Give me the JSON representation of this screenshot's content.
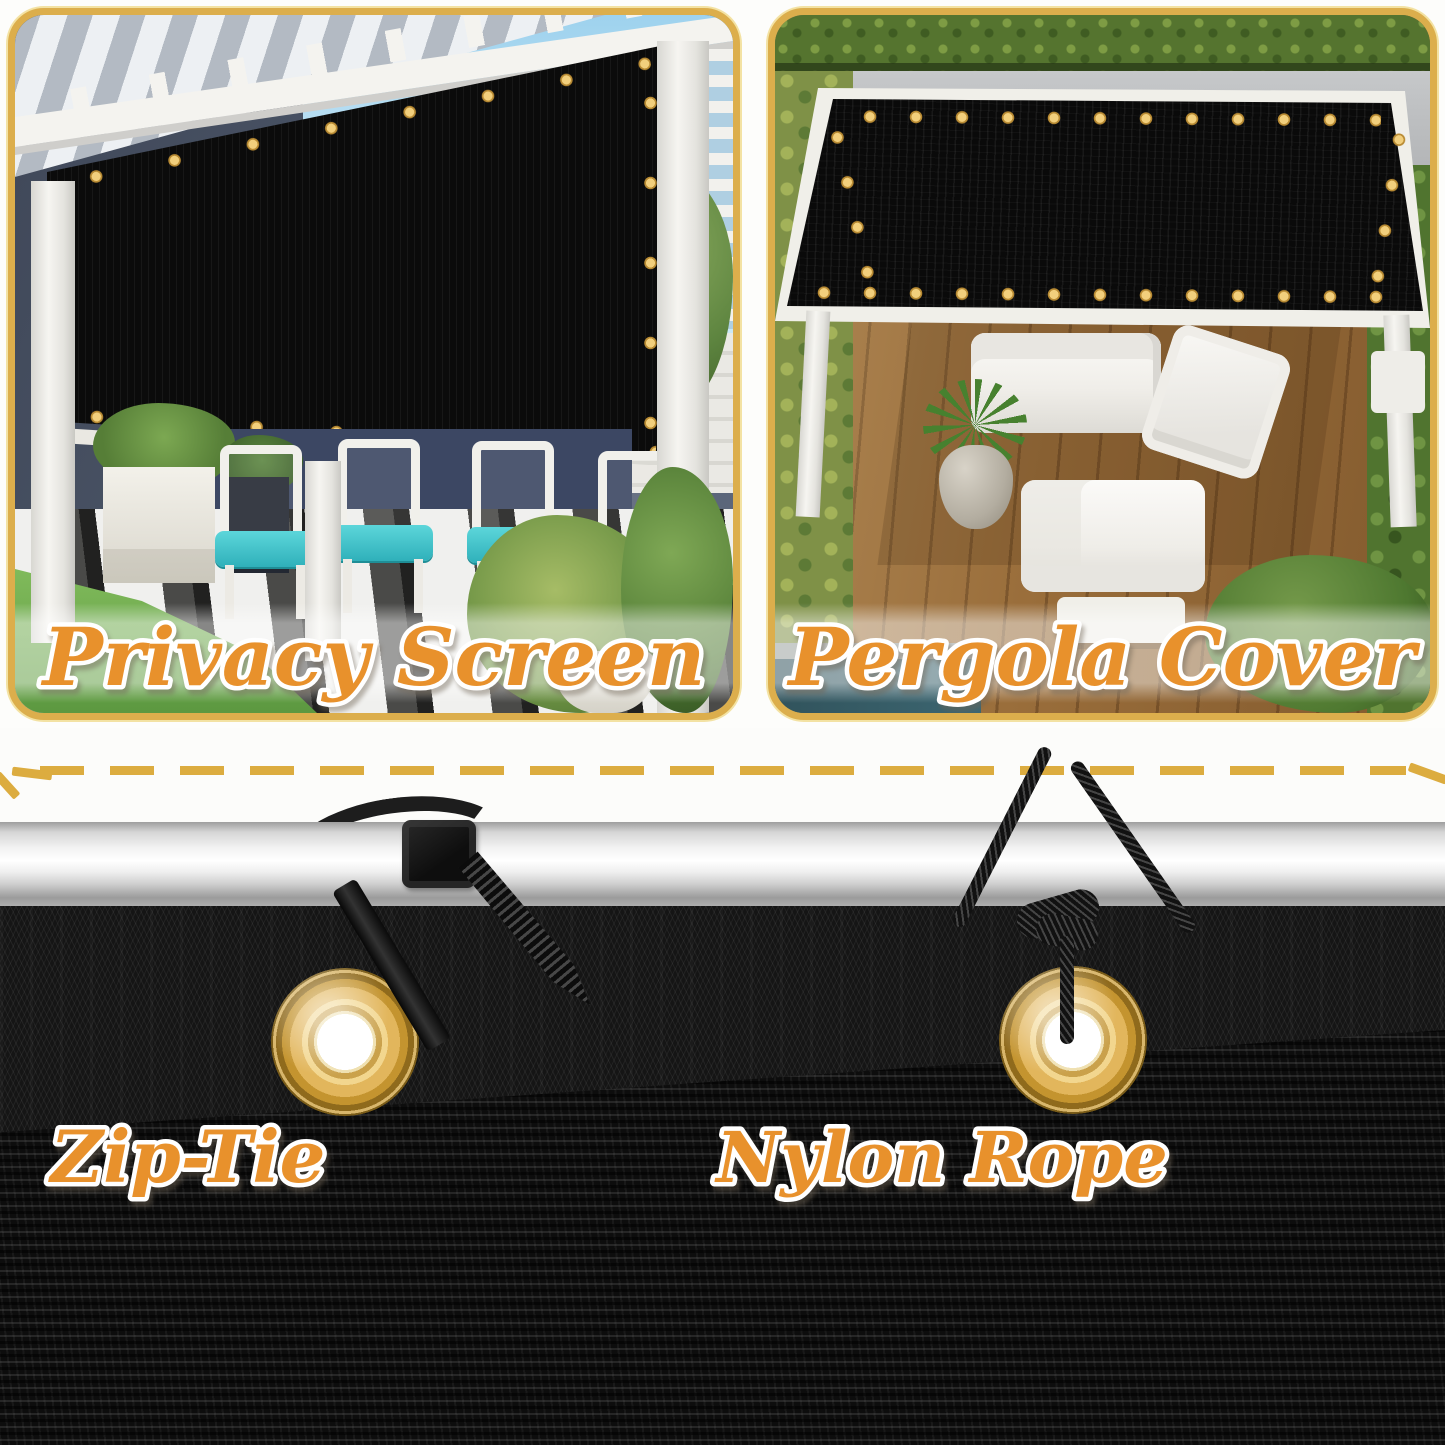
{
  "top_panels": {
    "privacy_screen": {
      "caption": "Privacy Screen"
    },
    "pergola_cover": {
      "caption": "Pergola Cover"
    }
  },
  "bottom_panel": {
    "zip_tie_caption": "Zip-Tie",
    "nylon_rope_caption": "Nylon Rope"
  },
  "colors": {
    "frame_gold": "#DCAE4C",
    "dash_gold": "#DCAC3F",
    "caption_orange": "#E8912C",
    "caption_outline": "#FFFFFF",
    "grommet_gold": "#D9A843",
    "fabric_black": "#121212",
    "cushion_teal": "#3FC3CB"
  }
}
